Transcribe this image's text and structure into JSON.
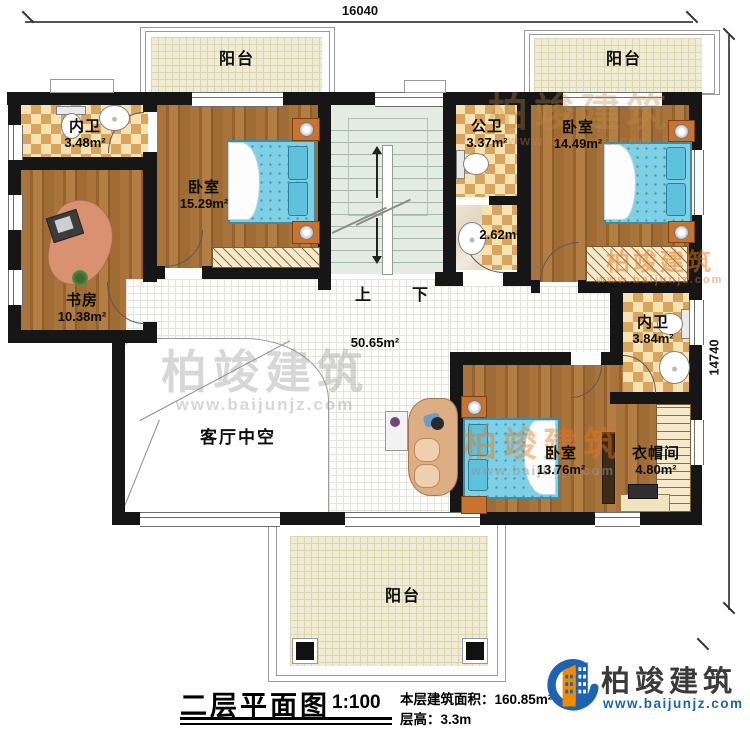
{
  "dimensions": {
    "width": "16040",
    "height": "14740"
  },
  "rooms": {
    "balconyTL": {
      "name": "阳台"
    },
    "balconyTR": {
      "name": "阳台"
    },
    "balconyBottom": {
      "name": "阳台"
    },
    "bathTL": {
      "name": "内卫",
      "area": "3.48m²"
    },
    "bedroomTL": {
      "name": "卧室",
      "area": "15.29m²"
    },
    "publicBath": {
      "name": "公卫",
      "area": "3.37m²"
    },
    "publicBathLower": {
      "area": "2.62m²"
    },
    "bedroomTR": {
      "name": "卧室",
      "area": "14.49m²"
    },
    "study": {
      "name": "书房",
      "area": "10.38m²"
    },
    "bathRight": {
      "name": "内卫",
      "area": "3.84m²"
    },
    "living": {
      "name": "客厅中空",
      "area": "50.65m²"
    },
    "bedroomBottom": {
      "name": "卧室",
      "area": "13.76m²"
    },
    "cloakroom": {
      "name": "衣帽间",
      "area": "4.80m²"
    }
  },
  "stairs": {
    "up": "上",
    "down": "下"
  },
  "titleBlock": {
    "title": "二层平面图",
    "scale": "1:100",
    "areaNote": "本层建筑面积：160.85m²",
    "heightNote": "层高：3.3m"
  },
  "brand": {
    "name": "柏竣建筑",
    "website": "www.baijunjz.com"
  },
  "watermark": {
    "name": "柏竣建筑",
    "website": "www.baijunjz.com"
  },
  "colors": {
    "brandBlue": "#1e63b0",
    "brandOrange": "#f28a00",
    "wallBlack": "#161616"
  }
}
